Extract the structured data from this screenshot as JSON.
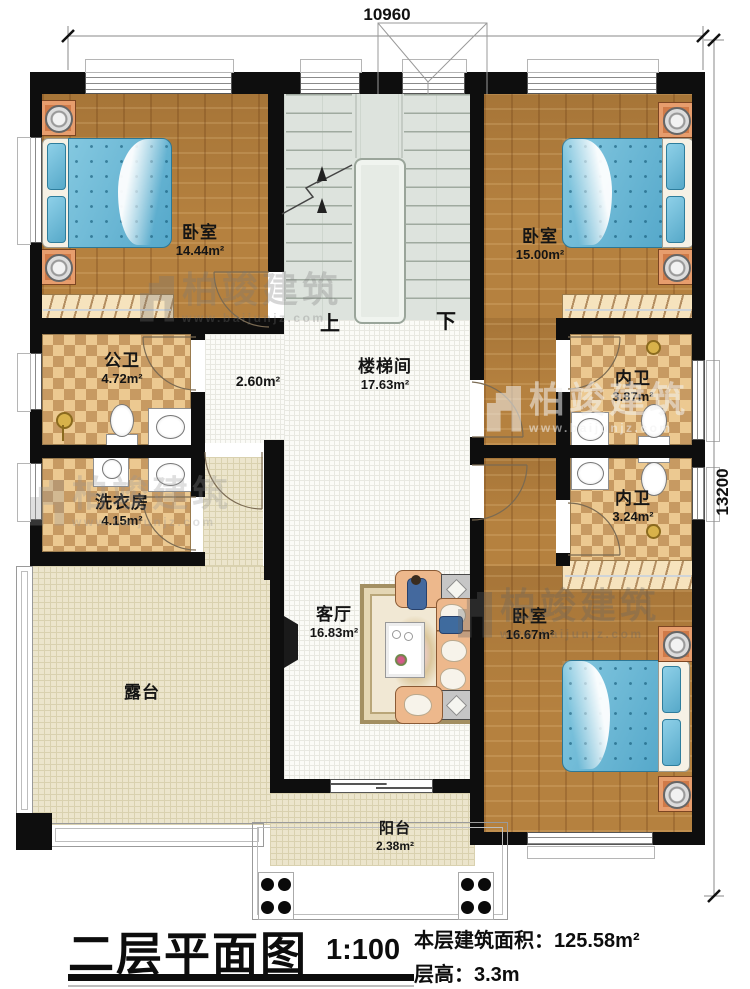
{
  "dimensions": {
    "width_top": "10960",
    "height_right": "13200"
  },
  "watermark": {
    "brand": "柏竣建筑",
    "site": "www.baijunjz.com"
  },
  "stairs": {
    "up": "上",
    "down": "下"
  },
  "rooms": {
    "bedroom_tl": {
      "name": "卧室",
      "area": "14.44m²"
    },
    "bedroom_tr": {
      "name": "卧室",
      "area": "15.00m²"
    },
    "bedroom_br": {
      "name": "卧室",
      "area": "16.67m²"
    },
    "public_bath": {
      "name": "公卫",
      "area": "4.72m²"
    },
    "laundry": {
      "name": "洗衣房",
      "area": "4.15m²"
    },
    "ensuite_1": {
      "name": "内卫",
      "area": "3.87m²"
    },
    "ensuite_2": {
      "name": "内卫",
      "area": "3.24m²"
    },
    "stairwell": {
      "name": "楼梯间",
      "area": "17.63m²"
    },
    "hallway": {
      "area": "2.60m²"
    },
    "living": {
      "name": "客厅",
      "area": "16.83m²"
    },
    "terrace": {
      "name": "露台"
    },
    "balcony": {
      "name": "阳台",
      "area": "2.38m²"
    }
  },
  "title_block": {
    "title": "二层平面图",
    "scale": "1:100",
    "floor_area_label": "本层建筑面积：",
    "floor_area_value": "125.58m²",
    "floor_height_label": "层高：",
    "floor_height_value": "3.3m"
  }
}
